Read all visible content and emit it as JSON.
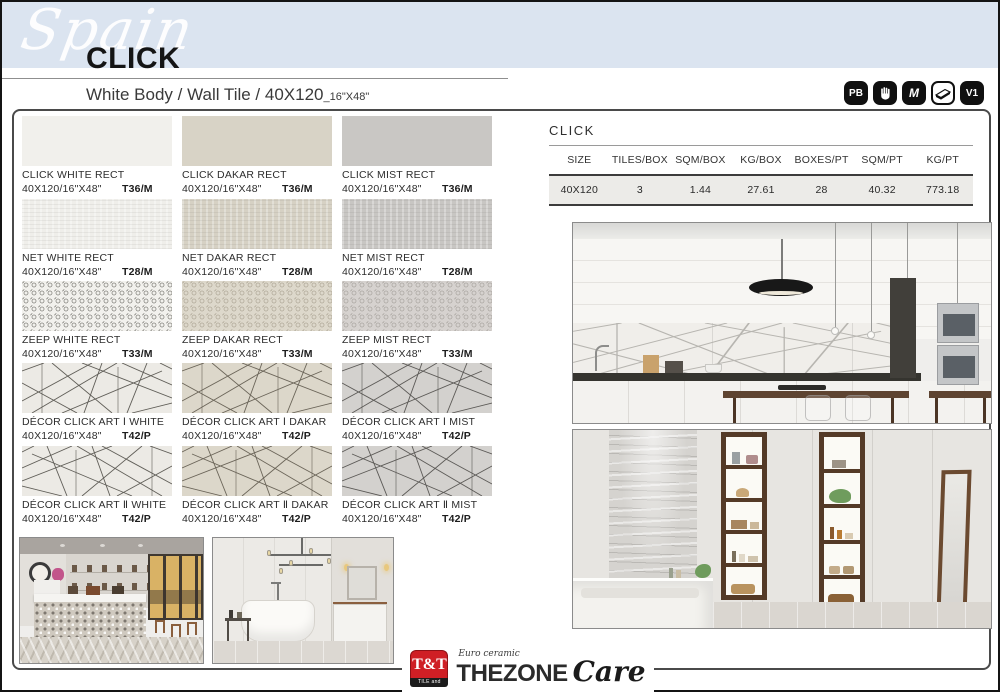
{
  "page": {
    "region_script": "Spain",
    "title": "CLICK",
    "subtitle_main": "White Body / Wall Tile / 40X120",
    "subtitle_inches": "_16\"X48\""
  },
  "badges": [
    {
      "label": "PB",
      "icon": "pb-badge"
    },
    {
      "label": "",
      "icon": "hand-icon"
    },
    {
      "label": "M",
      "icon": "m-badge"
    },
    {
      "label": "",
      "icon": "tile-slab-icon"
    },
    {
      "label": "V1",
      "icon": "v1-badge"
    }
  ],
  "spec_table": {
    "title": "CLICK",
    "headers": [
      "SIZE",
      "TILES/BOX",
      "SQM/BOX",
      "KG/BOX",
      "BOXES/PT",
      "SQM/PT",
      "KG/PT"
    ],
    "row": [
      "40X120",
      "3",
      "1.44",
      "27.61",
      "28",
      "40.32",
      "773.18"
    ]
  },
  "products": [
    {
      "name": "CLICK WHITE RECT",
      "size": "40X120/16\"X48\"",
      "code": "T36/M"
    },
    {
      "name": "CLICK DAKAR RECT",
      "size": "40X120/16\"X48\"",
      "code": "T36/M"
    },
    {
      "name": "CLICK MIST RECT",
      "size": "40X120/16\"X48\"",
      "code": "T36/M"
    },
    {
      "name": "NET WHITE RECT",
      "size": "40X120/16\"X48\"",
      "code": "T28/M"
    },
    {
      "name": "NET DAKAR RECT",
      "size": "40X120/16\"X48\"",
      "code": "T28/M"
    },
    {
      "name": "NET MIST RECT",
      "size": "40X120/16\"X48\"",
      "code": "T28/M"
    },
    {
      "name": "ZEEP WHITE RECT",
      "size": "40X120/16\"X48\"",
      "code": "T33/M"
    },
    {
      "name": "ZEEP DAKAR RECT",
      "size": "40X120/16\"X48\"",
      "code": "T33/M"
    },
    {
      "name": "ZEEP MIST RECT",
      "size": "40X120/16\"X48\"",
      "code": "T33/M"
    },
    {
      "name": "DÉCOR CLICK ART Ⅰ WHITE",
      "size": "40X120/16\"X48\"",
      "code": "T42/P"
    },
    {
      "name": "DÉCOR CLICK ART Ⅰ DAKAR",
      "size": "40X120/16\"X48\"",
      "code": "T42/P"
    },
    {
      "name": "DÉCOR CLICK ART Ⅰ MIST",
      "size": "40X120/16\"X48\"",
      "code": "T42/P"
    },
    {
      "name": "DÉCOR CLICK ART Ⅱ WHITE",
      "size": "40X120/16\"X48\"",
      "code": "T42/P"
    },
    {
      "name": "DÉCOR CLICK ART Ⅱ DAKAR",
      "size": "40X120/16\"X48\"",
      "code": "T42/P"
    },
    {
      "name": "DÉCOR CLICK ART Ⅱ MIST",
      "size": "40X120/16\"X48\"",
      "code": "T42/P"
    }
  ],
  "logo": {
    "tt_mark": "T&T",
    "tt_band": "TILE and TRADE",
    "euro_ceramic": "Euro ceramic",
    "thezone": "THEZONE",
    "care": "Care"
  },
  "colors": {
    "header_band": "#dbe4f0",
    "badge_black": "#101010",
    "logo_red": "#cf1f25",
    "tile_white": "#f1f0ec",
    "tile_dakar": "#d8d3c6",
    "tile_mist": "#c9c7c4",
    "table_row_bg": "#ecebe8"
  }
}
